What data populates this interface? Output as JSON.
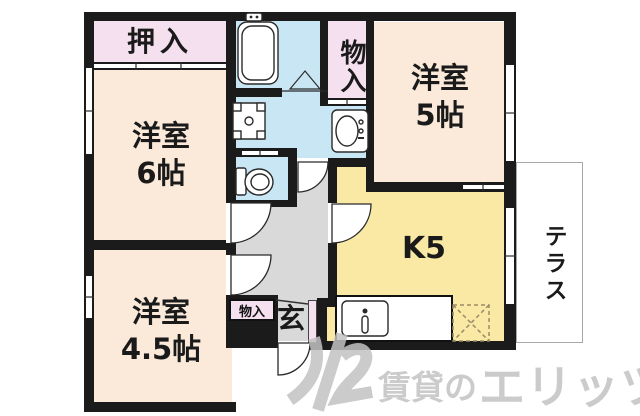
{
  "rooms": {
    "oshiire": {
      "label": "押入"
    },
    "western6": {
      "name": "洋室",
      "size": "6帖"
    },
    "western5": {
      "name": "洋室",
      "size": "5帖"
    },
    "western45": {
      "name": "洋室",
      "size": "4.5帖"
    },
    "kitchen": {
      "label": "K5"
    },
    "terrace": {
      "label": "テラス"
    },
    "storage_top": {
      "label": "物入"
    },
    "storage_hall": {
      "label": "物入"
    },
    "entrance": {
      "label": "玄"
    }
  },
  "watermark": {
    "prefix": "賃貸の",
    "brand": "エリッツ"
  },
  "fixtures": [
    "bathtub",
    "bath-folding-door",
    "washing-machine-pan",
    "washbasin",
    "toilet",
    "kitchen-sink",
    "refrigerator-space",
    "hinged-door",
    "sliding-door",
    "window",
    "entrance-step"
  ],
  "colors": {
    "room": "#fbe9d9",
    "closet": "#f4e0ef",
    "wet": "#c9e6f5",
    "kitchen": "#f9e9a5",
    "hall": "#d9d9d9",
    "wall": "#1b1b1b",
    "fixture_line": "#2a2a2a",
    "watermark": "#c2c2c2"
  }
}
